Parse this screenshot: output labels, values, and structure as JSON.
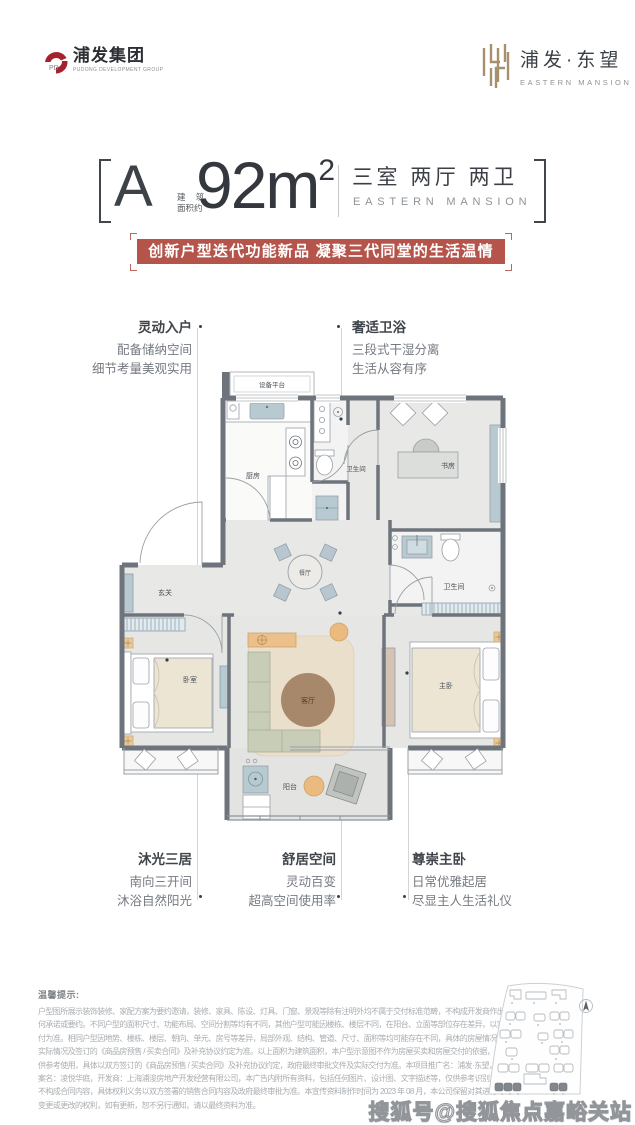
{
  "header": {
    "left_logo": {
      "name": "浦发集团",
      "subtitle": "PUDONG DEVELOPMENT GROUP"
    },
    "right_logo": {
      "name": "浦发·东望",
      "subtitle": "EASTERN MANSION"
    }
  },
  "title": {
    "unit": "A",
    "area_prefix_line1": "建 筑",
    "area_prefix_line2": "面积约",
    "area_value": "92m",
    "area_sup": "2",
    "rooms_cn": "三室 两厅 两卫",
    "rooms_en": "EASTERN MANSION"
  },
  "banner": {
    "text": "创新户型迭代功能新品 凝聚三代同堂的生活温情",
    "bg_color": "#b5544a"
  },
  "callouts": {
    "top_left": {
      "title": "灵动入户",
      "lines": [
        "配备储纳空间",
        "细节考量美观实用"
      ]
    },
    "top_right": {
      "title": "奢适卫浴",
      "lines": [
        "三段式干湿分离",
        "生活从容有序"
      ]
    },
    "bottom_left": {
      "title": "沐光三居",
      "lines": [
        "南向三开间",
        "沐浴自然阳光"
      ]
    },
    "bottom_center": {
      "title": "舒居空间",
      "lines": [
        "灵动百变",
        "超高空间使用率"
      ]
    },
    "bottom_right": {
      "title": "尊崇主卧",
      "lines": [
        "日常优雅起居",
        "尽显主人生活礼仪"
      ]
    }
  },
  "floorplan": {
    "labels": {
      "equipment": "设备平台",
      "kitchen": "厨房",
      "bath1": "卫生间",
      "study": "书房",
      "entry": "玄关",
      "dining": "餐厅",
      "bath2": "卫生间",
      "bedroom": "卧室",
      "living": "客厅",
      "master": "主卧",
      "balcony": "阳台"
    },
    "colors": {
      "wall": "#6e747c",
      "floor": "#e8e8e6",
      "rug_beige": "#eadfcb",
      "rug_center_brown": "#a8886a",
      "sofa_sage": "#c7cdb6",
      "cabinet_blue": "#b7c9d1",
      "accent_orange": "#ecc08a"
    }
  },
  "disclaimer": {
    "title": "温馨提示:",
    "lines": [
      "户型图所展示装饰装修、家配方案为要约邀请，装修、家具、陈设、灯具、门窗、景观等除有注明外均不属于交付标准范畴，不构成开发商作出的任",
      "何承诺或要约。不同户型的面积尺寸、功能布局、空间分割等均有不同，其他户型可能因楼栋、楼层不同，在阳台、立面等部位存在差异，以实际交",
      "付为准。相同户型因地势、楼栋、楼层、朝向、单元、房号等差异，局部外观、结构、管道、尺寸、面积等均可能存在不同，具体的房屋情况以交付时",
      "实际情况及签订的《商品房预售 / 买卖合同》及补充协议约定为准。以上面积为建筑面积，本户型示意图不作为房屋买卖和房屋交付的依据，仅",
      "供参考使用，具体以双方签订的《商品房预售 / 买卖合同》及补充协议约定，政府最终审批文件及实际交付为准。本项目推广名：浦发·东望，备",
      "案名：凌悦华庭，开发商：上海浦浚房地产开发经营有限公司，本广告内附所有资料，包括任何图片、设计图、文字描述等，仅供参考识别之用，",
      "不构成合同内容，具体权利义务以双方签署的销售合同内容及政府最终审批为准。本宣传资料制作时间为 2023 年 08 月，本公司保留对其进行",
      "变更或更改的权利，如有更新，恕不另行通知，请以最终资料为准。"
    ]
  },
  "watermark": "搜狐号@搜狐焦点嘉峪关站"
}
